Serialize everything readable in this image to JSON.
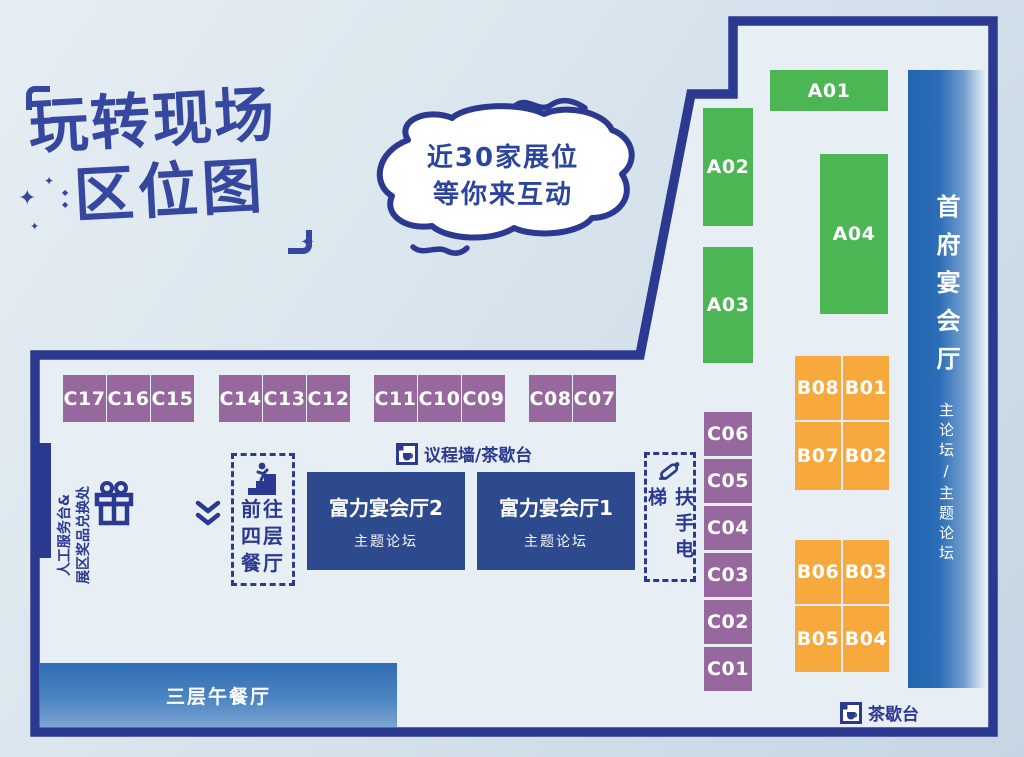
{
  "title": {
    "line1": "玩转现场",
    "line2": "区位图"
  },
  "bubble": {
    "line1": "近30家展位",
    "line2": "等你来互动"
  },
  "halls": {
    "shoufu": {
      "name": "首府宴会厅",
      "forum": "主论坛/主题论坛"
    },
    "fuli2": {
      "name": "富力宴会厅2",
      "forum": "主题论坛"
    },
    "fuli1": {
      "name": "富力宴会厅1",
      "forum": "主题论坛"
    },
    "lunch3f": {
      "name": "三层午餐厅"
    }
  },
  "booths": {
    "a": [
      "A01",
      "A02",
      "A03",
      "A04"
    ],
    "b": [
      "B08",
      "B01",
      "B07",
      "B02",
      "B06",
      "B03",
      "B05",
      "B04"
    ],
    "c_row": [
      "C17",
      "C16",
      "C15",
      "C14",
      "C13",
      "C12",
      "C11",
      "C10",
      "C09",
      "C08",
      "C07"
    ],
    "c_col": [
      "C06",
      "C05",
      "C04",
      "C03",
      "C02",
      "C01"
    ]
  },
  "labels": {
    "agenda_tea": "议程墙/茶歇台",
    "tea": "茶歇台",
    "escalator": "扶手电梯",
    "to_4f_line1": "前往",
    "to_4f_line2": "四层",
    "to_4f_line3": "餐厅",
    "service_line1": "人工服务台&",
    "service_line2": "展区奖品兑换处"
  },
  "decor": {
    "sparkle": "✦",
    "diamond": "◆"
  },
  "colors": {
    "wall_navy": "#2b3a90",
    "title_blue": "#36479f",
    "booth_green": "#4cb554",
    "booth_orange": "#f7a93e",
    "booth_purple": "#97689e",
    "hall_blue": "#2e4a8f",
    "bar_blue_dark": "#2265b0",
    "lunch_blue": "#2f6db4",
    "bg_light": "#e6eef3"
  }
}
